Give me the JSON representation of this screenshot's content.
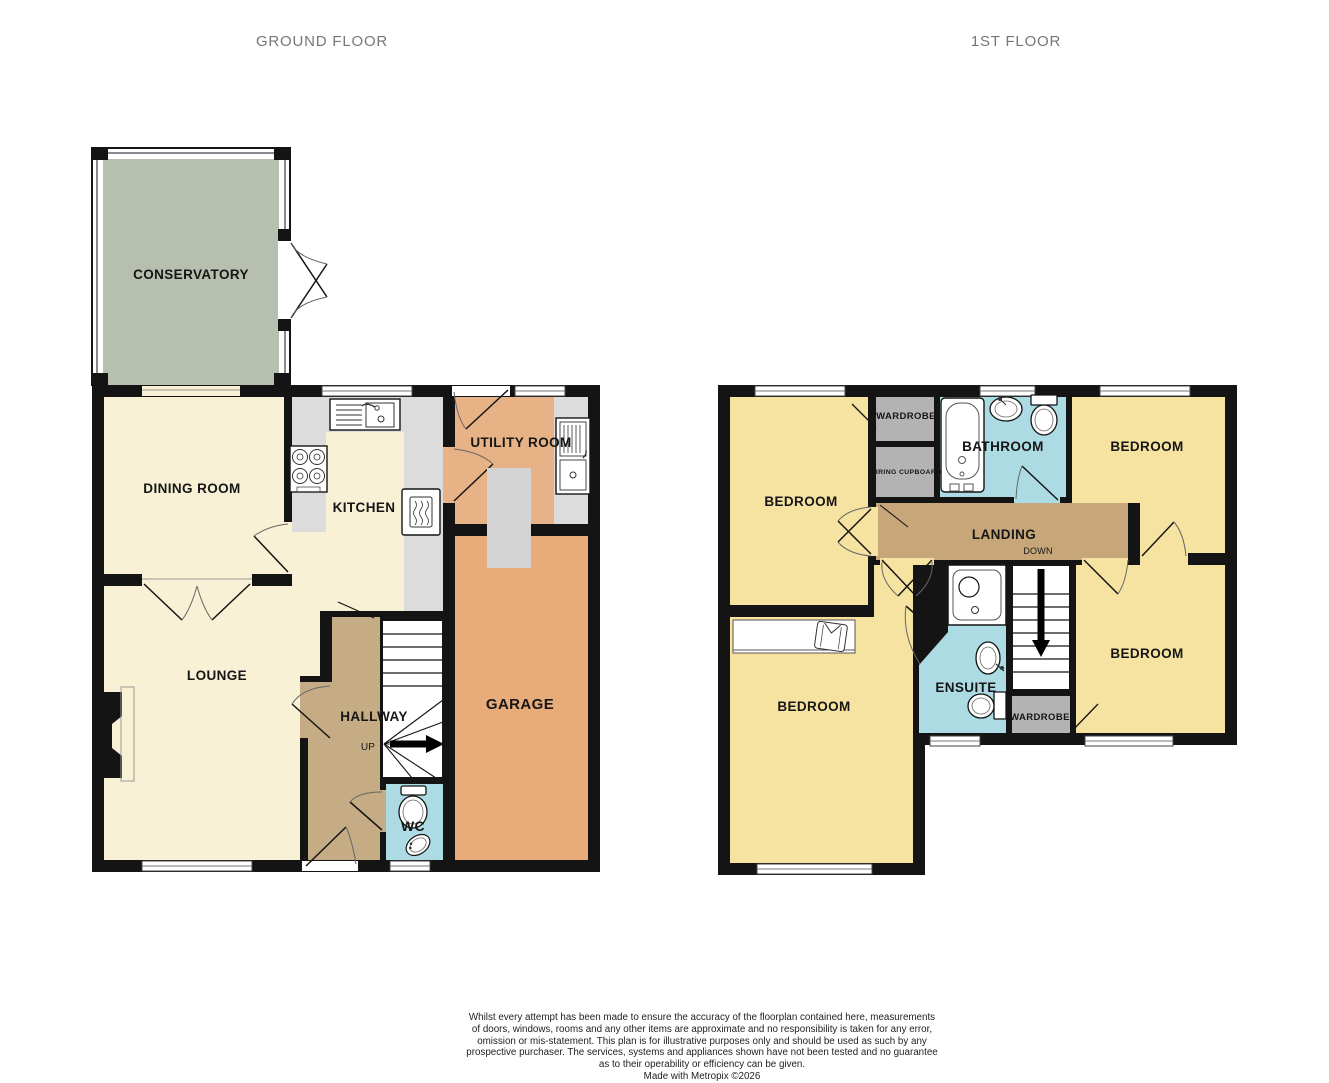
{
  "titles": {
    "ground": "GROUND FLOOR",
    "first": "1ST FLOOR"
  },
  "ground_floor": {
    "rooms": {
      "conservatory": "CONSERVATORY",
      "dining_room": "DINING ROOM",
      "kitchen": "KITCHEN",
      "utility_room": "UTILITY ROOM",
      "lounge": "LOUNGE",
      "hallway": "HALLWAY",
      "garage": "GARAGE",
      "wc": "WC"
    },
    "stairs_label": "UP"
  },
  "first_floor": {
    "rooms": {
      "bedroom_top_left": "BEDROOM",
      "wardrobe_top": "WARDROBE",
      "airing_cupboard": "AIRING CUPBOARD",
      "bathroom": "BATHROOM",
      "bedroom_top_right": "BEDROOM",
      "landing": "LANDING",
      "bedroom_bottom_left": "BEDROOM",
      "ensuite": "ENSUITE",
      "wardrobe_bottom": "WARDROBE",
      "bedroom_bottom_right": "BEDROOM"
    },
    "stairs_label": "DOWN"
  },
  "footer": {
    "lines": [
      "Whilst every attempt has been made to ensure the accuracy of the floorplan contained here, measurements",
      "of doors, windows, rooms and any other items are approximate and no responsibility is taken for any error,",
      "omission or mis-statement. This plan is for illustrative purposes only and should be used as such by any",
      "prospective purchaser. The services, systems and appliances shown have not been tested and no guarantee",
      "as to their operability or efficiency can be given.",
      "Made with Metropix ©2026"
    ]
  },
  "colors": {
    "wall": "#141414",
    "room_cream": "#f8f1d5",
    "bedroom_yellow": "#f6e3a1",
    "conservatory_sage": "#b7bfae",
    "garage_orange": "#e8ab7a",
    "utility_orange": "#e8b287",
    "hallway_tan": "#c5ac85",
    "landing_tan": "#c7a77a",
    "bathroom_blue": "#addbe4",
    "cupboard_gray": "#b3b3b3",
    "counter_gray": "#dcdcdc",
    "title_gray": "#777777"
  },
  "fixtures": [
    "kitchen-sink",
    "stove",
    "boiler",
    "utility-sink",
    "toilet",
    "corner-basin",
    "bath",
    "pedestal-sink",
    "shower",
    "ensuite-sink",
    "built-in-wardrobe",
    "fireplace",
    "chimney-breast",
    "stairs-up-arrow",
    "stairs-down-arrow"
  ]
}
